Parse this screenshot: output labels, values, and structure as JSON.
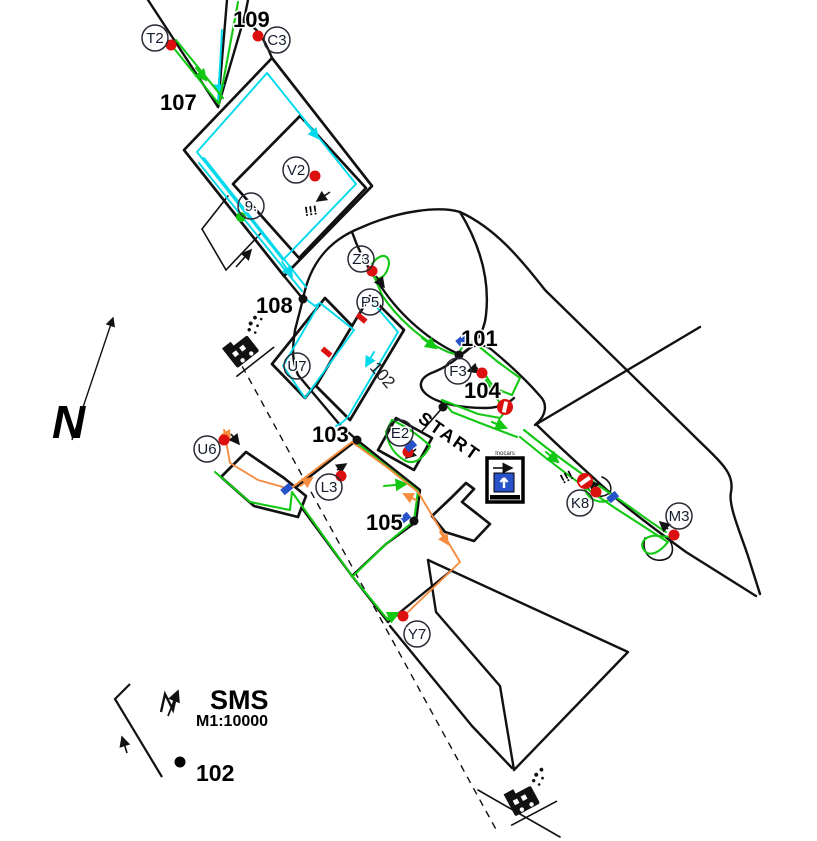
{
  "map": {
    "title": "SMS",
    "scale": "M1:10000",
    "north_label": "N",
    "start_label": "START",
    "building_label": "102",
    "legend_sample_label": "102",
    "info_box_label": "Inocars",
    "warning_1": "!!!",
    "warning_2": "!!!",
    "checkpoints": [
      {
        "number": "109"
      },
      {
        "number": "107"
      },
      {
        "number": "108"
      },
      {
        "number": "101"
      },
      {
        "number": "104"
      },
      {
        "number": "103"
      },
      {
        "number": "105"
      }
    ],
    "controls": [
      {
        "label": "T2"
      },
      {
        "label": "C3"
      },
      {
        "label": "V2"
      },
      {
        "label": "9."
      },
      {
        "label": "Z3"
      },
      {
        "label": "P5"
      },
      {
        "label": "U7"
      },
      {
        "label": "F3"
      },
      {
        "label": "E2"
      },
      {
        "label": "U6"
      },
      {
        "label": "L3"
      },
      {
        "label": "K8"
      },
      {
        "label": "M3"
      },
      {
        "label": "Y7"
      }
    ]
  },
  "colors": {
    "track_green": "#12c812",
    "track_cyan": "#00d9ec",
    "track_orange": "#f78b3d",
    "marker_red": "#dd1010",
    "marker_green": "#12c812",
    "marker_blue": "#2752c9",
    "road_black": "#111111"
  }
}
